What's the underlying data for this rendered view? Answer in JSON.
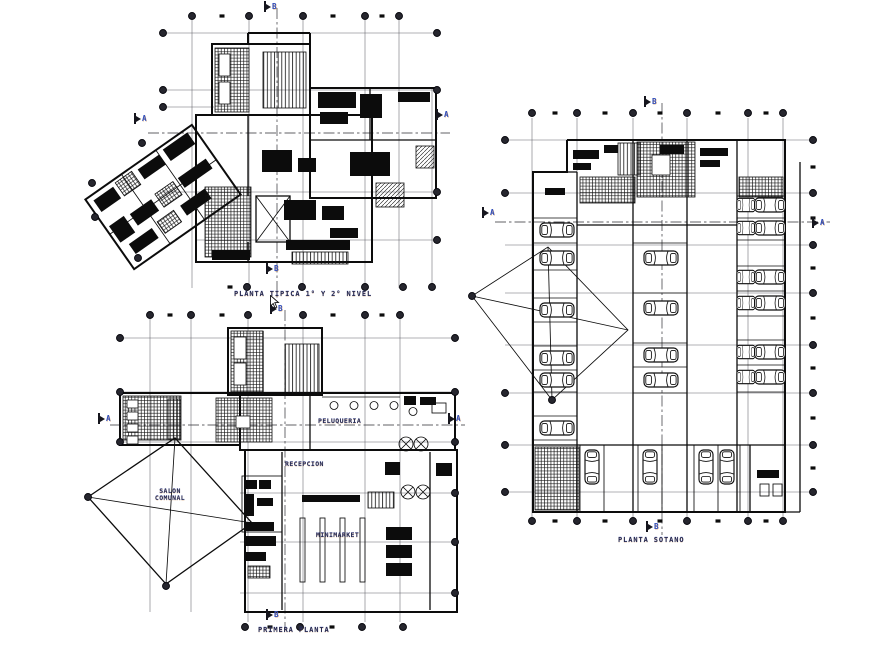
{
  "titles": {
    "typical": "PLANTA TIPICA 1° Y 2° NIVEL",
    "first": "PRIMERA PLANTA",
    "basement": "PLANTA SOTANO"
  },
  "rooms": {
    "peluqueria": "PELUQUERIA",
    "recepcion": "RECEPCION",
    "salon_line1": "SALON",
    "salon_line2": "COMUNAL",
    "minimarket": "MINIMARKET"
  },
  "section_markers": {
    "a": "A",
    "b": "B"
  },
  "colors": {
    "background": "#ffffff",
    "ink": "#111111",
    "label_text": "#252a52",
    "section_letter": "#2f4fc0",
    "bubble_fill": "#26262e"
  },
  "icons": {
    "grid_bubble": "grid-bubble-icon",
    "car": "car-icon",
    "section_flag": "section-cut-flag-icon",
    "cursor": "mouse-cursor-icon"
  }
}
